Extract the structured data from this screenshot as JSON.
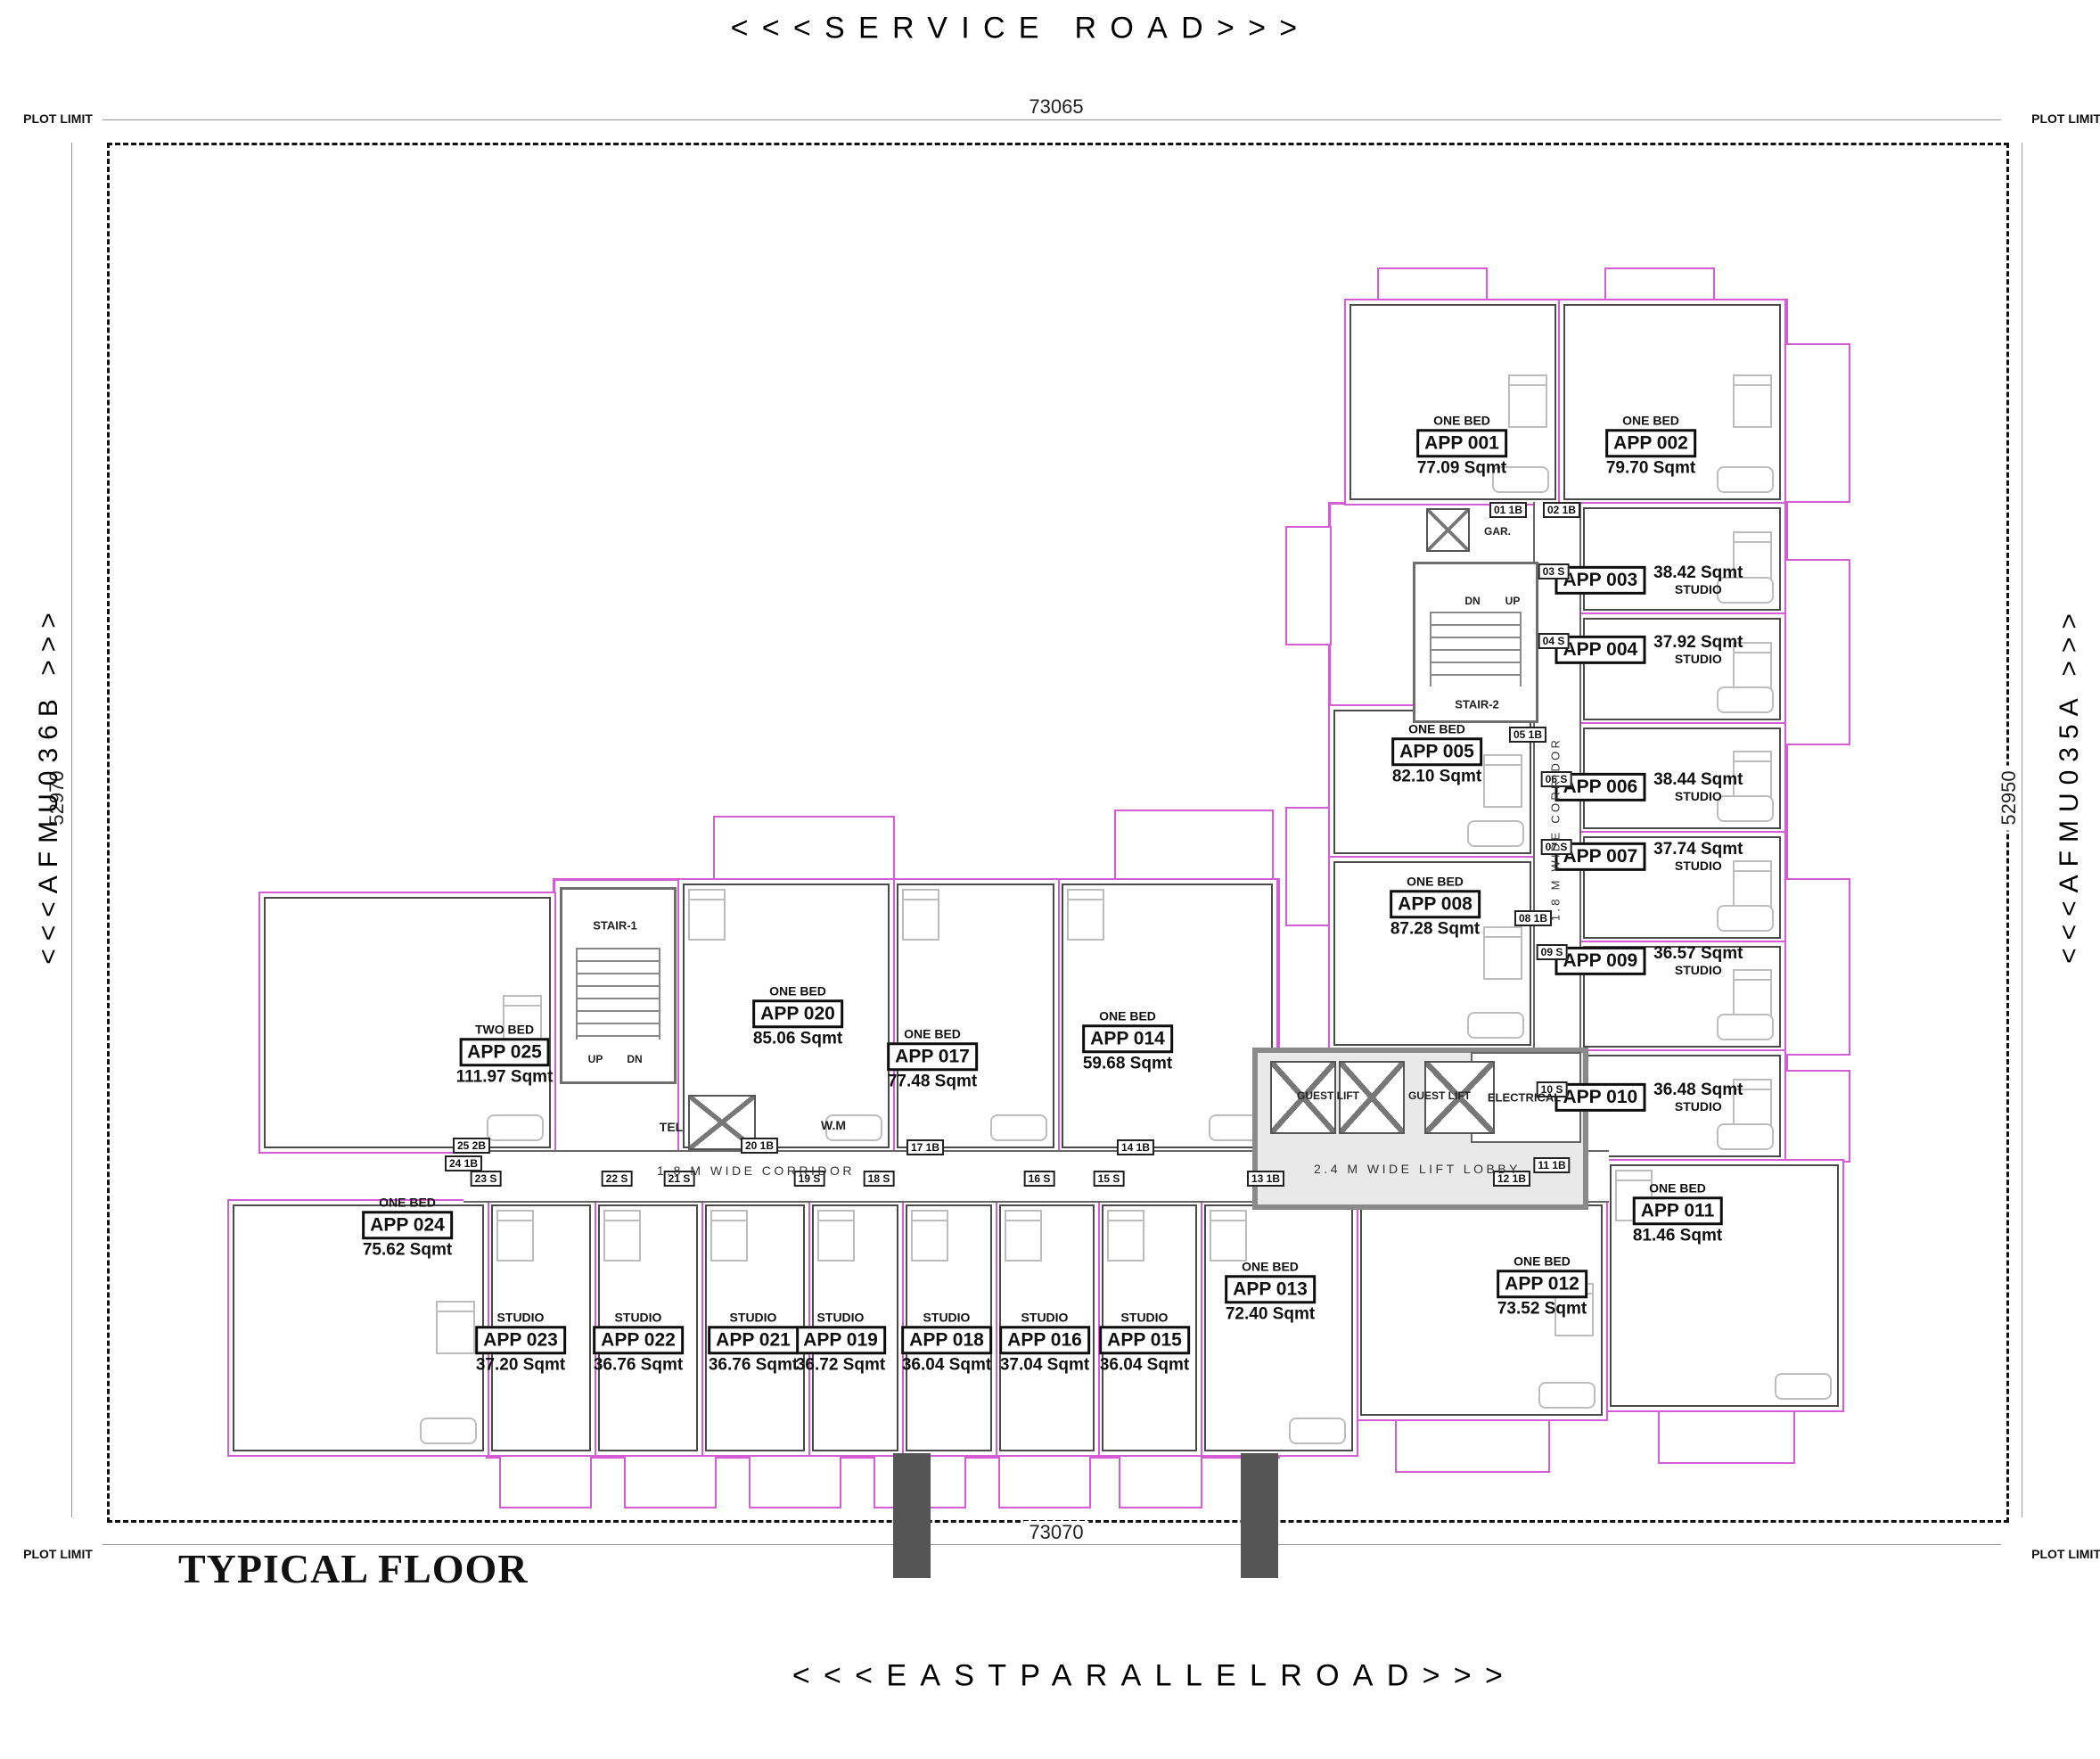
{
  "title": "TYPICAL FLOOR",
  "roads": {
    "top": "<<<SERVICE ROAD>>>",
    "bottom": "<<<EASTPARALLELROAD>>>",
    "left": "<<<AFMU036B >>>",
    "right": "<<<AFMU035A >>>"
  },
  "plot": {
    "limit": "PLOT LIMIT",
    "dim_top": "73065",
    "dim_bottom": "73070",
    "dim_left": "52970",
    "dim_right": "52950"
  },
  "corridors": {
    "horizontal": "1.8 M WIDE CORRIDOR",
    "vertical": "1.8 M WIDE CORRIDOR",
    "lobby": "2.4 M WIDE LIFT LOBBY"
  },
  "core": {
    "stair1": "STAIR-1",
    "stair2": "STAIR-2",
    "up": "UP",
    "dn": "DN",
    "guest_lift": "GUEST LIFT",
    "electrical": "ELECTRICAL",
    "garbage": "GAR.",
    "telephone": "TEL",
    "washing_machine": "W.M"
  },
  "colors": {
    "unit_boundary": "#d45cd4",
    "wall": "#4a4a4a",
    "dimension": "#999999"
  },
  "apartments": [
    {
      "label": "APP 001",
      "type": "ONE BED",
      "area": "77.09 Sqmt",
      "tag": "01 1B"
    },
    {
      "label": "APP 002",
      "type": "ONE BED",
      "area": "79.70 Sqmt",
      "tag": "02 1B"
    },
    {
      "label": "APP 003",
      "type": "STUDIO",
      "area": "38.42 Sqmt",
      "tag": "03 S"
    },
    {
      "label": "APP 004",
      "type": "STUDIO",
      "area": "37.92 Sqmt",
      "tag": "04 S"
    },
    {
      "label": "APP 005",
      "type": "ONE BED",
      "area": "82.10 Sqmt",
      "tag": "05 1B"
    },
    {
      "label": "APP 006",
      "type": "STUDIO",
      "area": "38.44 Sqmt",
      "tag": "06 S"
    },
    {
      "label": "APP 007",
      "type": "STUDIO",
      "area": "37.74 Sqmt",
      "tag": "07 S"
    },
    {
      "label": "APP 008",
      "type": "ONE BED",
      "area": "87.28 Sqmt",
      "tag": "08 1B"
    },
    {
      "label": "APP 009",
      "type": "STUDIO",
      "area": "36.57 Sqmt",
      "tag": "09 S"
    },
    {
      "label": "APP 010",
      "type": "STUDIO",
      "area": "36.48 Sqmt",
      "tag": "10 S"
    },
    {
      "label": "APP 011",
      "type": "ONE BED",
      "area": "81.46 Sqmt",
      "tag": "11 1B"
    },
    {
      "label": "APP 012",
      "type": "ONE BED",
      "area": "73.52 Sqmt",
      "tag": "12 1B"
    },
    {
      "label": "APP 013",
      "type": "ONE BED",
      "area": "72.40 Sqmt",
      "tag": "13 1B"
    },
    {
      "label": "APP 014",
      "type": "ONE BED",
      "area": "59.68 Sqmt",
      "tag": "14 1B"
    },
    {
      "label": "APP 015",
      "type": "STUDIO",
      "area": "36.04 Sqmt",
      "tag": "15 S"
    },
    {
      "label": "APP 016",
      "type": "STUDIO",
      "area": "37.04 Sqmt",
      "tag": "16 S"
    },
    {
      "label": "APP 017",
      "type": "ONE BED",
      "area": "77.48 Sqmt",
      "tag": "17 1B"
    },
    {
      "label": "APP 018",
      "type": "STUDIO",
      "area": "36.04 Sqmt",
      "tag": "18 S"
    },
    {
      "label": "APP 019",
      "type": "STUDIO",
      "area": "36.72 Sqmt",
      "tag": "19 S"
    },
    {
      "label": "APP 020",
      "type": "ONE BED",
      "area": "85.06 Sqmt",
      "tag": "20 1B"
    },
    {
      "label": "APP 021",
      "type": "STUDIO",
      "area": "36.76 Sqmt",
      "tag": "21 S"
    },
    {
      "label": "APP 022",
      "type": "STUDIO",
      "area": "36.76 Sqmt",
      "tag": "22 S"
    },
    {
      "label": "APP 023",
      "type": "STUDIO",
      "area": "37.20 Sqmt",
      "tag": "23 S"
    },
    {
      "label": "APP 024",
      "type": "ONE BED",
      "area": "75.62 Sqmt",
      "tag": "24 1B"
    },
    {
      "label": "APP 025",
      "type": "TWO BED",
      "area": "111.97 Sqmt",
      "tag": "25 2B"
    }
  ]
}
